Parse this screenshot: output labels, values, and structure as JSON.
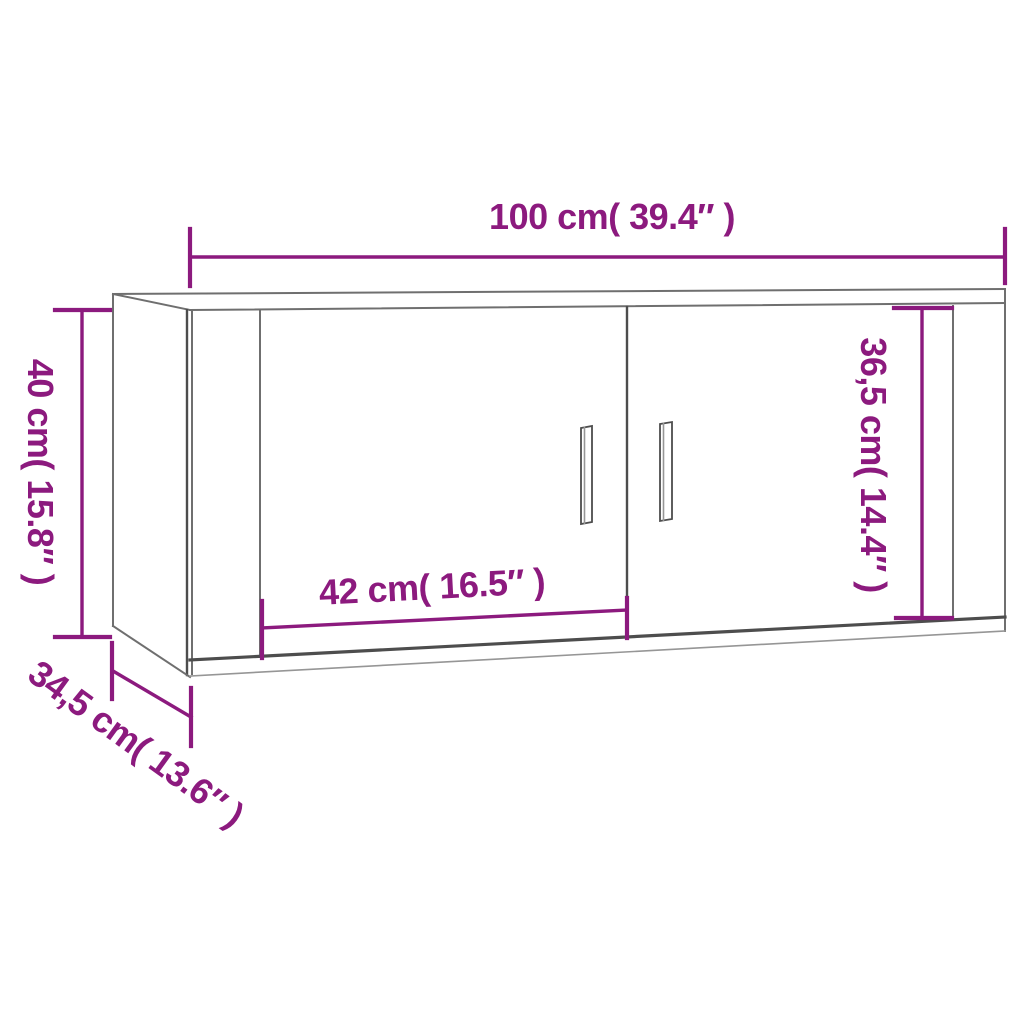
{
  "diagram": {
    "kind": "furniture dimension line drawing",
    "labels": {
      "width": "100 cm( 39.4″ )",
      "height": "40 cm( 15.8″ )",
      "inner_height": "36,5 cm( 14.4″ )",
      "door_width": "42 cm( 16.5″ )",
      "depth": "34,5 cm( 13.6″ )"
    }
  },
  "colors": {
    "accent": "#8C1A7E",
    "outline": "#6F6F6F",
    "outline_dark": "#4D4D4D",
    "outline_light": "#969696",
    "background": "#FFFFFF"
  }
}
